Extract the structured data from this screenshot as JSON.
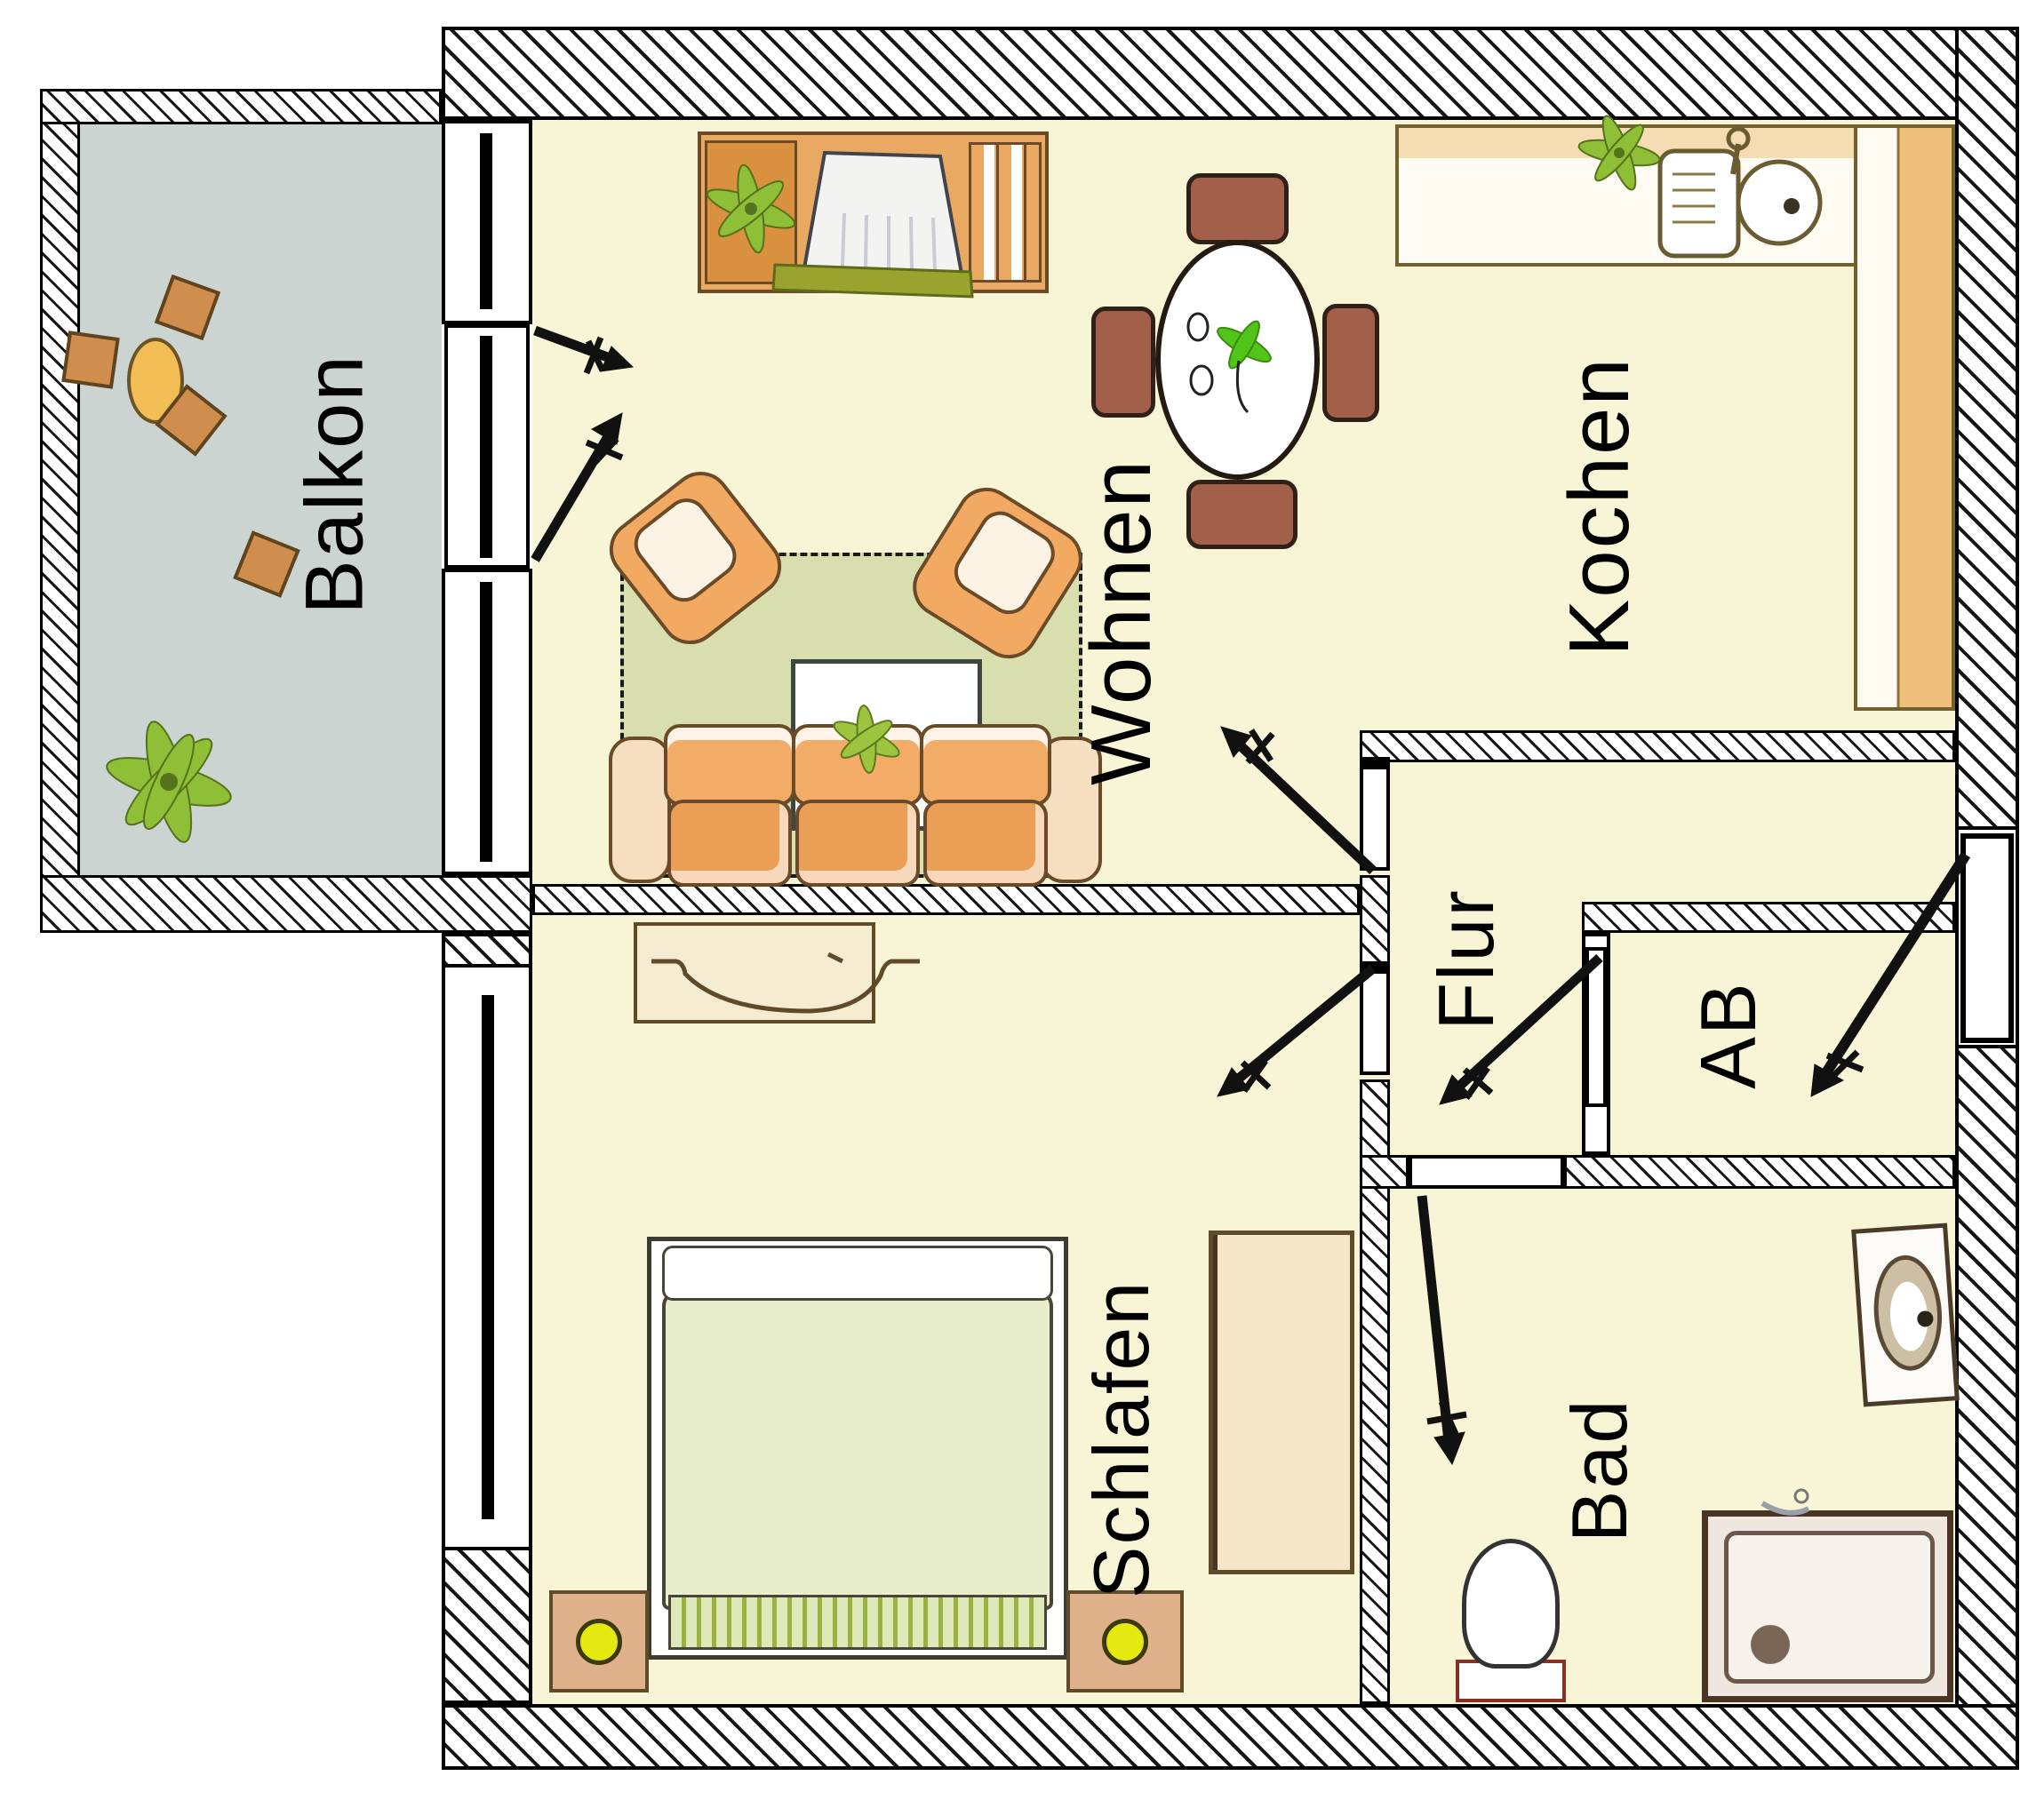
{
  "rooms": {
    "balkon": {
      "label": "Balkon"
    },
    "wohnen": {
      "label": "Wohnen"
    },
    "kochen": {
      "label": "Kochen"
    },
    "flur": {
      "label": "Flur"
    },
    "ab": {
      "label": "AB"
    },
    "schlafen": {
      "label": "Schlafen"
    },
    "bad": {
      "label": "Bad"
    }
  },
  "colors": {
    "apartment_floor": "#f8f5d7",
    "balcony_floor": "#ccd4d1",
    "rug_green": "#d8deae",
    "wall_ink": "#000000",
    "wood_orange": "#e9a963",
    "counter_wood": "#eec07c",
    "chair_brown": "#a2604a",
    "plant_green": "#8fbe37",
    "blanket_green": "#e8eecb",
    "lamp_yellow": "#e6e812"
  },
  "furniture": [
    "balcony-table",
    "balcony-stool",
    "balcony-plant",
    "sideboard",
    "tv",
    "dining-table",
    "dining-chair",
    "armchair",
    "coffee-table",
    "sofa",
    "kitchen-counter",
    "kitchen-sink",
    "dresser",
    "bed",
    "nightstand",
    "wardrobe",
    "washbasin",
    "shower",
    "toilet",
    "door-swing-arrow",
    "window",
    "entrance-door"
  ]
}
